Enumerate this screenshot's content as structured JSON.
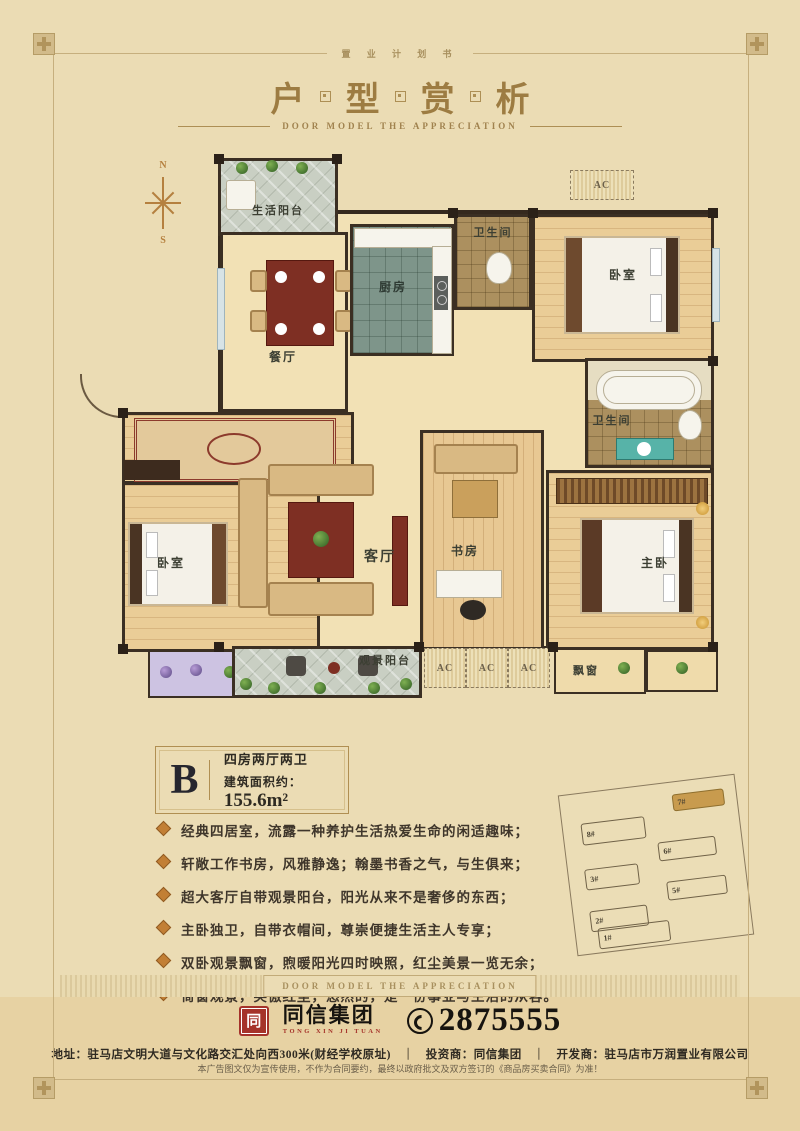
{
  "header": {
    "tagline": "置 业 计 划 书",
    "title_chars": [
      "户",
      "型",
      "赏",
      "析"
    ],
    "subtitle": "DOOR MODEL THE APPRECIATION"
  },
  "plan": {
    "labels": {
      "north": "N",
      "south": "S",
      "life_balcony": "生活阳台",
      "dining": "餐厅",
      "kitchen": "厨房",
      "bath_top": "卫生间",
      "bedroom_top": "卧室",
      "master_bath": "卫生间",
      "bedroom_left": "卧室",
      "living": "客厅",
      "study": "书房",
      "master": "主卧",
      "view_balcony": "观景阳台",
      "bay_window": "飘窗",
      "ac": "AC"
    }
  },
  "unit": {
    "letter": "B",
    "type": "四房两厅两卫",
    "area_label": "建筑面积约：",
    "area_value": "155.6m²"
  },
  "features": [
    "经典四居室，流露一种养护生活热爱生命的闲适趣味；",
    "轩敞工作书房，风雅静逸；翰墨书香之气，与生俱来；",
    "超大客厅自带观景阳台，阳光从来不是奢侈的东西；",
    "主卧独卫，自带衣帽间，尊崇便捷生活主人专享；",
    "双卧观景飘窗，煦暖阳光四时映照，红尘美景一览无余；",
    "倚窗观景，笑傲红尘，悠然的，是一份事业与生活的从容。"
  ],
  "site_plan": {
    "buildings": [
      {
        "label": "8#"
      },
      {
        "label": "7#",
        "highlighted": true
      },
      {
        "label": "6#"
      },
      {
        "label": "3#"
      },
      {
        "label": "5#"
      },
      {
        "label": "2#"
      },
      {
        "label": "1#"
      }
    ]
  },
  "band": {
    "text": "DOOR MODEL THE APPRECIATION"
  },
  "footer": {
    "logo_seal": "同",
    "logo_text": "同信集团",
    "logo_sub": "TONG XIN JI TUAN",
    "phone": "2875555",
    "address": "地址：驻马店文明大道与文化路交汇处向西300米(财经学校原址)",
    "divider": "｜",
    "investor": "投资商：同信集团",
    "developer": "开发商：驻马店市万润置业有限公司",
    "disclaimer": "本广告图文仅为宣传使用，不作为合同要约，最终以政府批文及双方签订的《商品房买卖合同》为准！"
  }
}
